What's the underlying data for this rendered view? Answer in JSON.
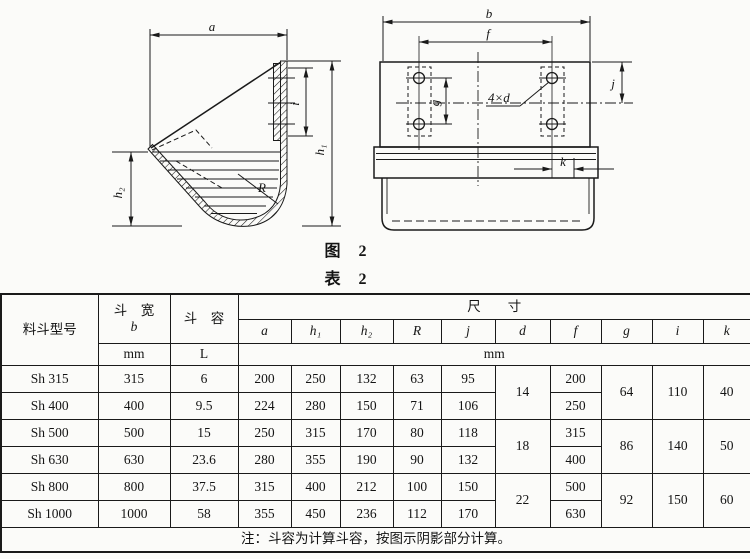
{
  "captions": {
    "figure": "图　2",
    "table": "表　2"
  },
  "fig": {
    "side": {
      "a": "a",
      "h1": "h₁",
      "h2": "h₂",
      "R": "R",
      "i": "i"
    },
    "front": {
      "b": "b",
      "f": "f",
      "g": "g",
      "holes": "4×d",
      "j": "j",
      "k": "k"
    }
  },
  "table": {
    "header": {
      "model": "料斗型号",
      "width_title": "斗　宽",
      "width_sym": "b",
      "width_unit": "mm",
      "cap_title": "斗　容",
      "cap_unit": "L",
      "dims_title": "尺　　寸",
      "dims_unit": "mm",
      "syms": [
        "a",
        "h₁",
        "h₂",
        "R",
        "j",
        "d",
        "f",
        "g",
        "i",
        "k"
      ]
    },
    "rows": [
      {
        "model": "Sh 315",
        "b": "315",
        "cap": "6",
        "a": "200",
        "h1": "250",
        "h2": "132",
        "R": "63",
        "j": "95",
        "f": "200"
      },
      {
        "model": "Sh 400",
        "b": "400",
        "cap": "9.5",
        "a": "224",
        "h1": "280",
        "h2": "150",
        "R": "71",
        "j": "106",
        "f": "250"
      },
      {
        "model": "Sh 500",
        "b": "500",
        "cap": "15",
        "a": "250",
        "h1": "315",
        "h2": "170",
        "R": "80",
        "j": "118",
        "f": "315"
      },
      {
        "model": "Sh 630",
        "b": "630",
        "cap": "23.6",
        "a": "280",
        "h1": "355",
        "h2": "190",
        "R": "90",
        "j": "132",
        "f": "400"
      },
      {
        "model": "Sh 800",
        "b": "800",
        "cap": "37.5",
        "a": "315",
        "h1": "400",
        "h2": "212",
        "R": "100",
        "j": "150",
        "f": "500"
      },
      {
        "model": "Sh 1000",
        "b": "1000",
        "cap": "58",
        "a": "355",
        "h1": "450",
        "h2": "236",
        "R": "112",
        "j": "170",
        "f": "630"
      }
    ],
    "groups": [
      {
        "d": "14",
        "g": "64",
        "i": "110",
        "k": "40"
      },
      {
        "d": "18",
        "g": "86",
        "i": "140",
        "k": "50"
      },
      {
        "d": "22",
        "g": "92",
        "i": "150",
        "k": "60"
      }
    ],
    "note": "注：斗容为计算斗容，按图示阴影部分计算。"
  }
}
